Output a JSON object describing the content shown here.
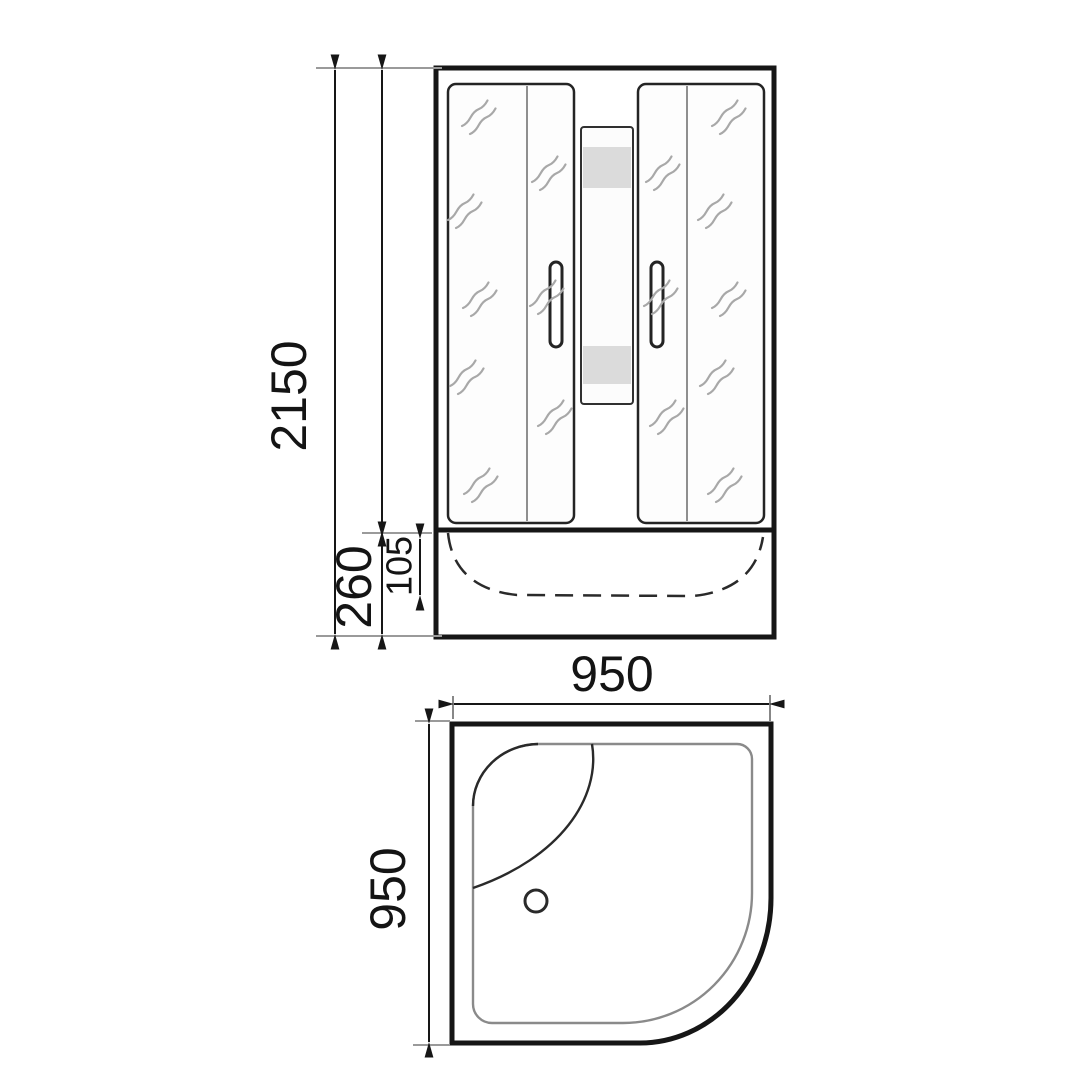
{
  "drawing": {
    "kind": "shower-cabin-technical-drawing",
    "views": [
      "front-elevation",
      "plan-view"
    ]
  },
  "front_view": {
    "dim_total_height": "2150",
    "dim_base_height": "260",
    "dim_tray_inner_depth": "105"
  },
  "plan_view": {
    "dim_width": "950",
    "dim_depth": "950"
  },
  "colors": {
    "background": "#ffffff",
    "main_line": "#161616",
    "extension_line": "#9a9a9a",
    "glass_reflection": "#a8a8a8",
    "shading_band": "#dbdbdb",
    "inner_outline": "#8a8a8a",
    "label_text": "#141414"
  }
}
